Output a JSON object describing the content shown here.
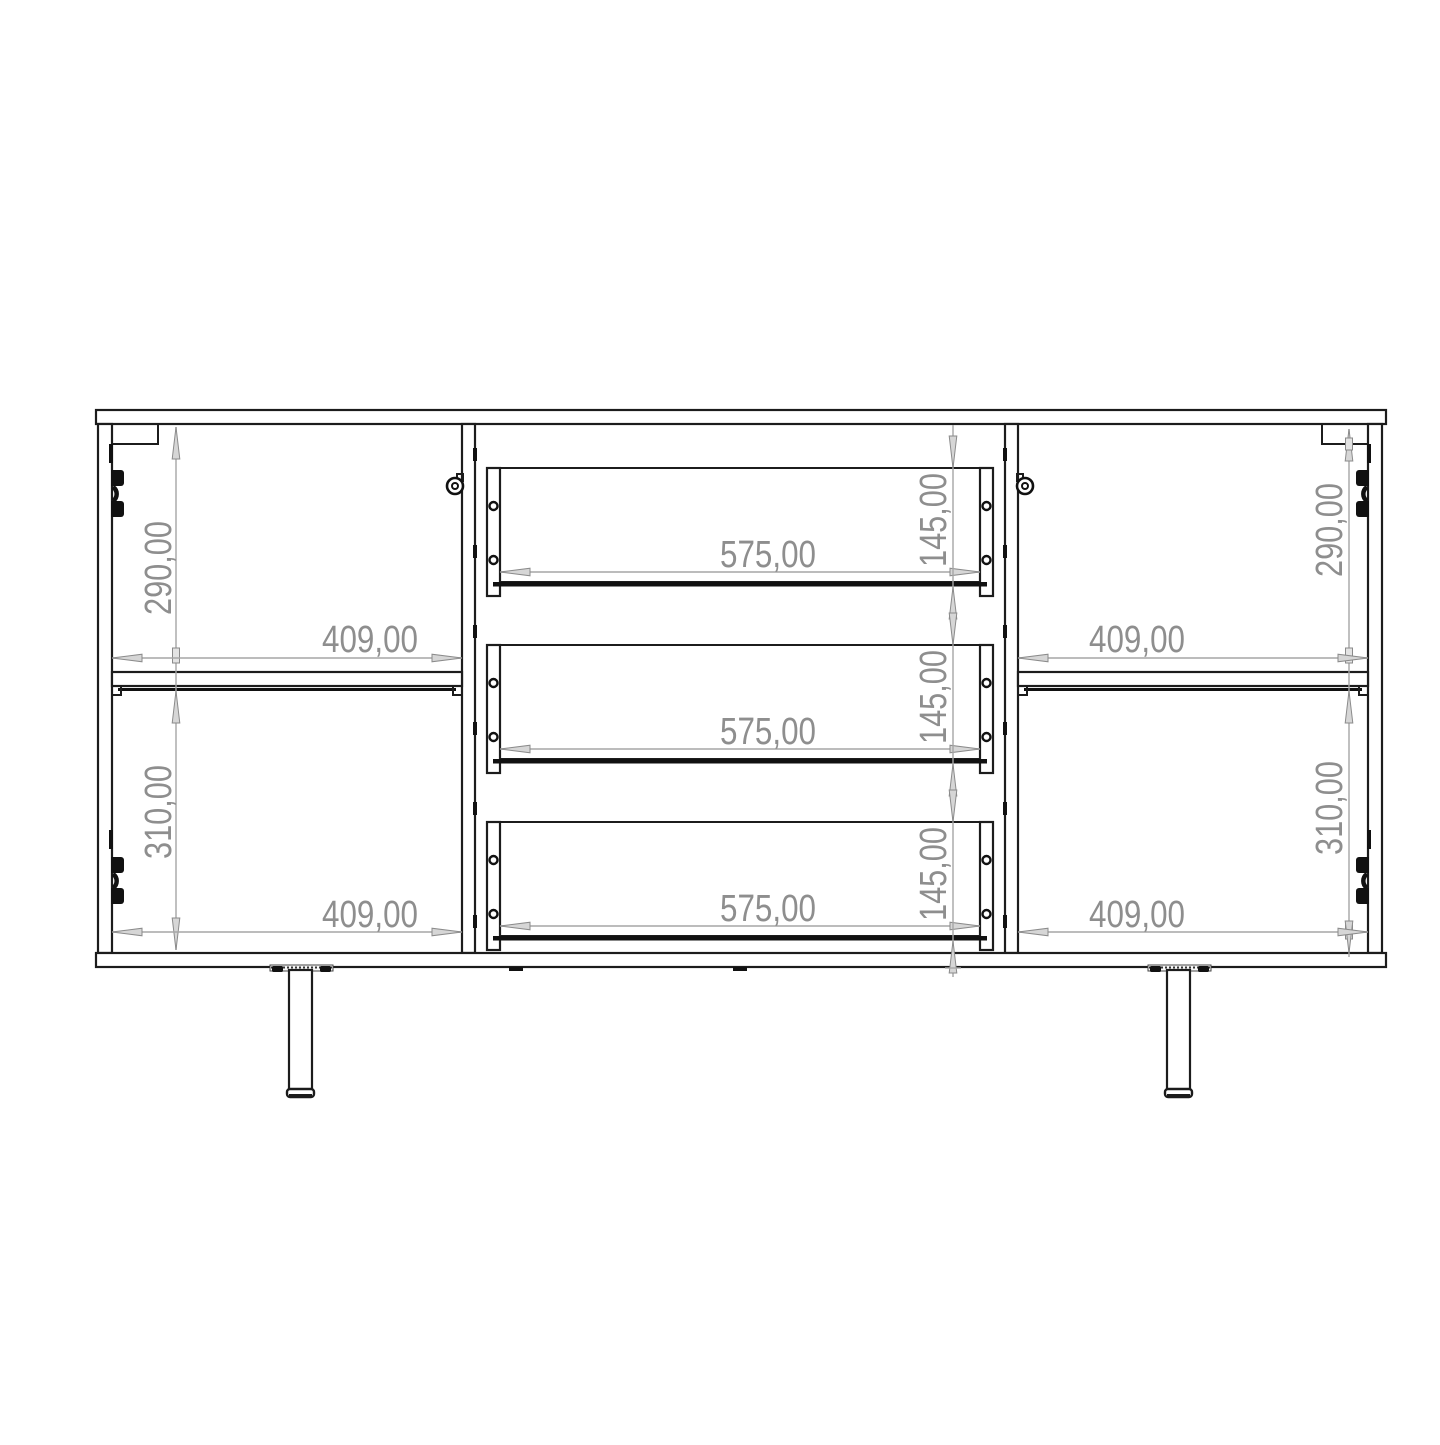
{
  "document": {
    "type": "technical-drawing",
    "subject": "sideboard front elevation with internal dimensions"
  },
  "colors": {
    "line": "#1c1c1c",
    "dimension_line": "#a6a6a6",
    "dimension_text": "#8e8e8e",
    "background": "#ffffff"
  },
  "labels": {
    "left_top_height": "290,00",
    "left_top_width": "409,00",
    "left_bottom_height": "310,00",
    "left_bottom_width": "409,00",
    "right_top_height": "290,00",
    "right_top_width": "409,00",
    "right_bottom_height": "310,00",
    "right_bottom_width": "409,00",
    "drawer1_width": "575,00",
    "drawer1_height": "145,00",
    "drawer2_width": "575,00",
    "drawer2_height": "145,00",
    "drawer3_width": "575,00",
    "drawer3_height": "145,00"
  }
}
